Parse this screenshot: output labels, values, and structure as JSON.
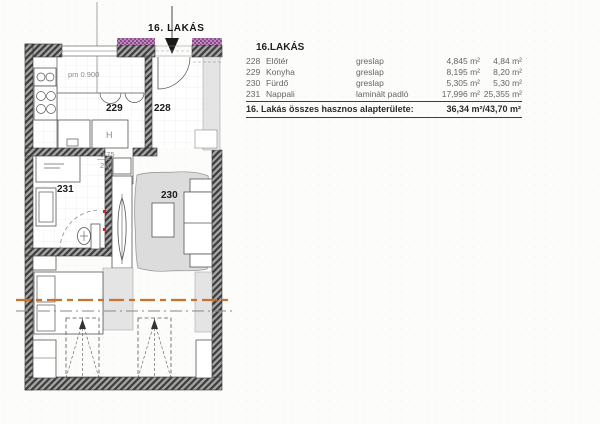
{
  "colors": {
    "accent-orange": "#c8732e",
    "accent-purple": "#8d4a8d",
    "dot-red": "#cc2222",
    "rug": "#dcdcdc"
  },
  "plan": {
    "title": "16. LAKÁS",
    "pm_label": "pm 0.900",
    "door_width": "0.75",
    "door_height": "2.10",
    "fridge_label": "H",
    "rooms": {
      "kitchen": "229",
      "entry": "228",
      "bath": "231",
      "living": "230"
    }
  },
  "table": {
    "header": "16.LAKÁS",
    "rows": [
      {
        "number": "228",
        "name": "Előtér",
        "finish": "greslap",
        "area": "4,845 m²",
        "area2": "4,84 m²"
      },
      {
        "number": "229",
        "name": "Konyha",
        "finish": "greslap",
        "area": "8,195 m²",
        "area2": "8,20 m²"
      },
      {
        "number": "230",
        "name": "Fürdő",
        "finish": "greslap",
        "area": "5,305 m²",
        "area2": "5,30 m²"
      },
      {
        "number": "231",
        "name": "Nappali",
        "finish": "laminált padló",
        "area": "17,996 m²",
        "area2": "25,355 m²"
      }
    ],
    "total_label": "16. Lakás összes hasznos alapterülete:",
    "total_value": "36,34 m²/43,70 m²"
  }
}
